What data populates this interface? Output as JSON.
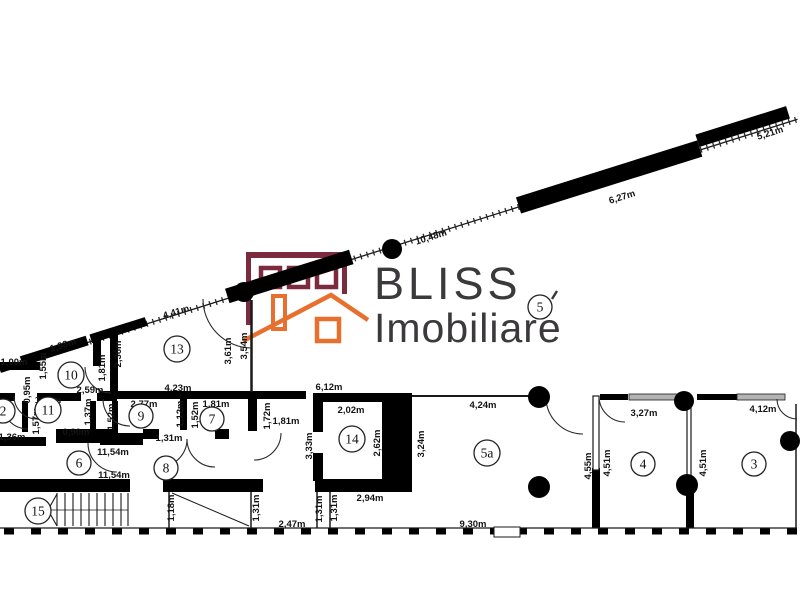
{
  "brand": {
    "line1": "BLISS",
    "line2": "Imobiliare",
    "maroon": "#7b2b3d",
    "orange": "#e8702e",
    "wordmark_color": "#3b393b"
  },
  "plan": {
    "ink": "#1a1a1a",
    "wall": "#000000",
    "window_gray": "#b3b3b3"
  },
  "rooms": [
    {
      "n": "2",
      "x": 3,
      "y": 411
    },
    {
      "n": "10",
      "x": 71,
      "y": 375
    },
    {
      "n": "11",
      "x": 48,
      "y": 410
    },
    {
      "n": "9",
      "x": 141,
      "y": 416
    },
    {
      "n": "7",
      "x": 212,
      "y": 419
    },
    {
      "n": "13",
      "x": 177,
      "y": 349
    },
    {
      "n": "8",
      "x": 166,
      "y": 468
    },
    {
      "n": "6",
      "x": 79,
      "y": 463
    },
    {
      "n": "15",
      "x": 38,
      "y": 511
    },
    {
      "n": "14",
      "x": 352,
      "y": 439
    },
    {
      "n": "5",
      "x": 540,
      "y": 307
    },
    {
      "n": "5a",
      "x": 487,
      "y": 453
    },
    {
      "n": "4",
      "x": 643,
      "y": 464
    },
    {
      "n": "3",
      "x": 754,
      "y": 464
    }
  ],
  "dimensions": [
    {
      "t": "5,21m",
      "x": 770,
      "y": 133,
      "o": "d"
    },
    {
      "t": "6,27m",
      "x": 622,
      "y": 197,
      "o": "d"
    },
    {
      "t": "10,48m",
      "x": 431,
      "y": 237,
      "o": "d"
    },
    {
      "t": "4,41m",
      "x": 176,
      "y": 312,
      "o": "d"
    },
    {
      "t": "1,98m",
      "x": 63,
      "y": 345,
      "o": "d"
    },
    {
      "t": "1,00m",
      "x": 14,
      "y": 362,
      "o": "h"
    },
    {
      "t": "2,59m",
      "x": 90,
      "y": 390,
      "o": "h"
    },
    {
      "t": "1,11m",
      "x": 48,
      "y": 400,
      "o": "h"
    },
    {
      "t": "0,90m",
      "x": 76,
      "y": 432,
      "o": "h"
    },
    {
      "t": "1,36m",
      "x": 12,
      "y": 437,
      "o": "h"
    },
    {
      "t": "2,77m",
      "x": 144,
      "y": 404,
      "o": "h"
    },
    {
      "t": "1,81m",
      "x": 216,
      "y": 404,
      "o": "h"
    },
    {
      "t": "1,31m",
      "x": 169,
      "y": 438,
      "o": "h"
    },
    {
      "t": "1,81m",
      "x": 286,
      "y": 421,
      "o": "h"
    },
    {
      "t": "4,23m",
      "x": 178,
      "y": 388,
      "o": "h"
    },
    {
      "t": "6,12m",
      "x": 329,
      "y": 387,
      "o": "h"
    },
    {
      "t": "2,02m",
      "x": 351,
      "y": 410,
      "o": "h"
    },
    {
      "t": "2,94m",
      "x": 370,
      "y": 498,
      "o": "h"
    },
    {
      "t": "4,24m",
      "x": 483,
      "y": 405,
      "o": "h"
    },
    {
      "t": "3,27m",
      "x": 644,
      "y": 413,
      "o": "h"
    },
    {
      "t": "4,12m",
      "x": 763,
      "y": 409,
      "o": "h"
    },
    {
      "t": "11,54m",
      "x": 113,
      "y": 452,
      "o": "h"
    },
    {
      "t": "11,54m",
      "x": 114,
      "y": 475,
      "o": "h"
    },
    {
      "t": "2,47m",
      "x": 292,
      "y": 524,
      "o": "h"
    },
    {
      "t": "9,30m",
      "x": 473,
      "y": 524,
      "o": "h"
    },
    {
      "t": "1,55m",
      "x": 43,
      "y": 366,
      "o": "v"
    },
    {
      "t": "0,95m",
      "x": 27,
      "y": 390,
      "o": "v"
    },
    {
      "t": "1,81m",
      "x": 102,
      "y": 368,
      "o": "v"
    },
    {
      "t": "2,36m",
      "x": 118,
      "y": 354,
      "o": "v"
    },
    {
      "t": "1,37m",
      "x": 88,
      "y": 412,
      "o": "v"
    },
    {
      "t": "1,57m",
      "x": 36,
      "y": 421,
      "o": "v"
    },
    {
      "t": "1,52m",
      "x": 111,
      "y": 417,
      "o": "v"
    },
    {
      "t": "1,12m",
      "x": 180,
      "y": 414,
      "o": "v"
    },
    {
      "t": "1,52m",
      "x": 195,
      "y": 415,
      "o": "v"
    },
    {
      "t": "1,72m",
      "x": 267,
      "y": 416,
      "o": "v"
    },
    {
      "t": "3,61m",
      "x": 228,
      "y": 351,
      "o": "v"
    },
    {
      "t": "3,54m",
      "x": 244,
      "y": 346,
      "o": "v"
    },
    {
      "t": "3,33m",
      "x": 309,
      "y": 446,
      "o": "v"
    },
    {
      "t": "2,62m",
      "x": 377,
      "y": 443,
      "o": "v"
    },
    {
      "t": "3,24m",
      "x": 421,
      "y": 444,
      "o": "v"
    },
    {
      "t": "1,31m",
      "x": 319,
      "y": 509,
      "o": "v"
    },
    {
      "t": "1,31m",
      "x": 334,
      "y": 508,
      "o": "v"
    },
    {
      "t": "4,55m",
      "x": 588,
      "y": 466,
      "o": "v"
    },
    {
      "t": "4,51m",
      "x": 607,
      "y": 463,
      "o": "v"
    },
    {
      "t": "4,51m",
      "x": 703,
      "y": 463,
      "o": "v"
    },
    {
      "t": "1,18m",
      "x": 171,
      "y": 508,
      "o": "v"
    },
    {
      "t": "1,31m",
      "x": 256,
      "y": 508,
      "o": "v"
    }
  ]
}
